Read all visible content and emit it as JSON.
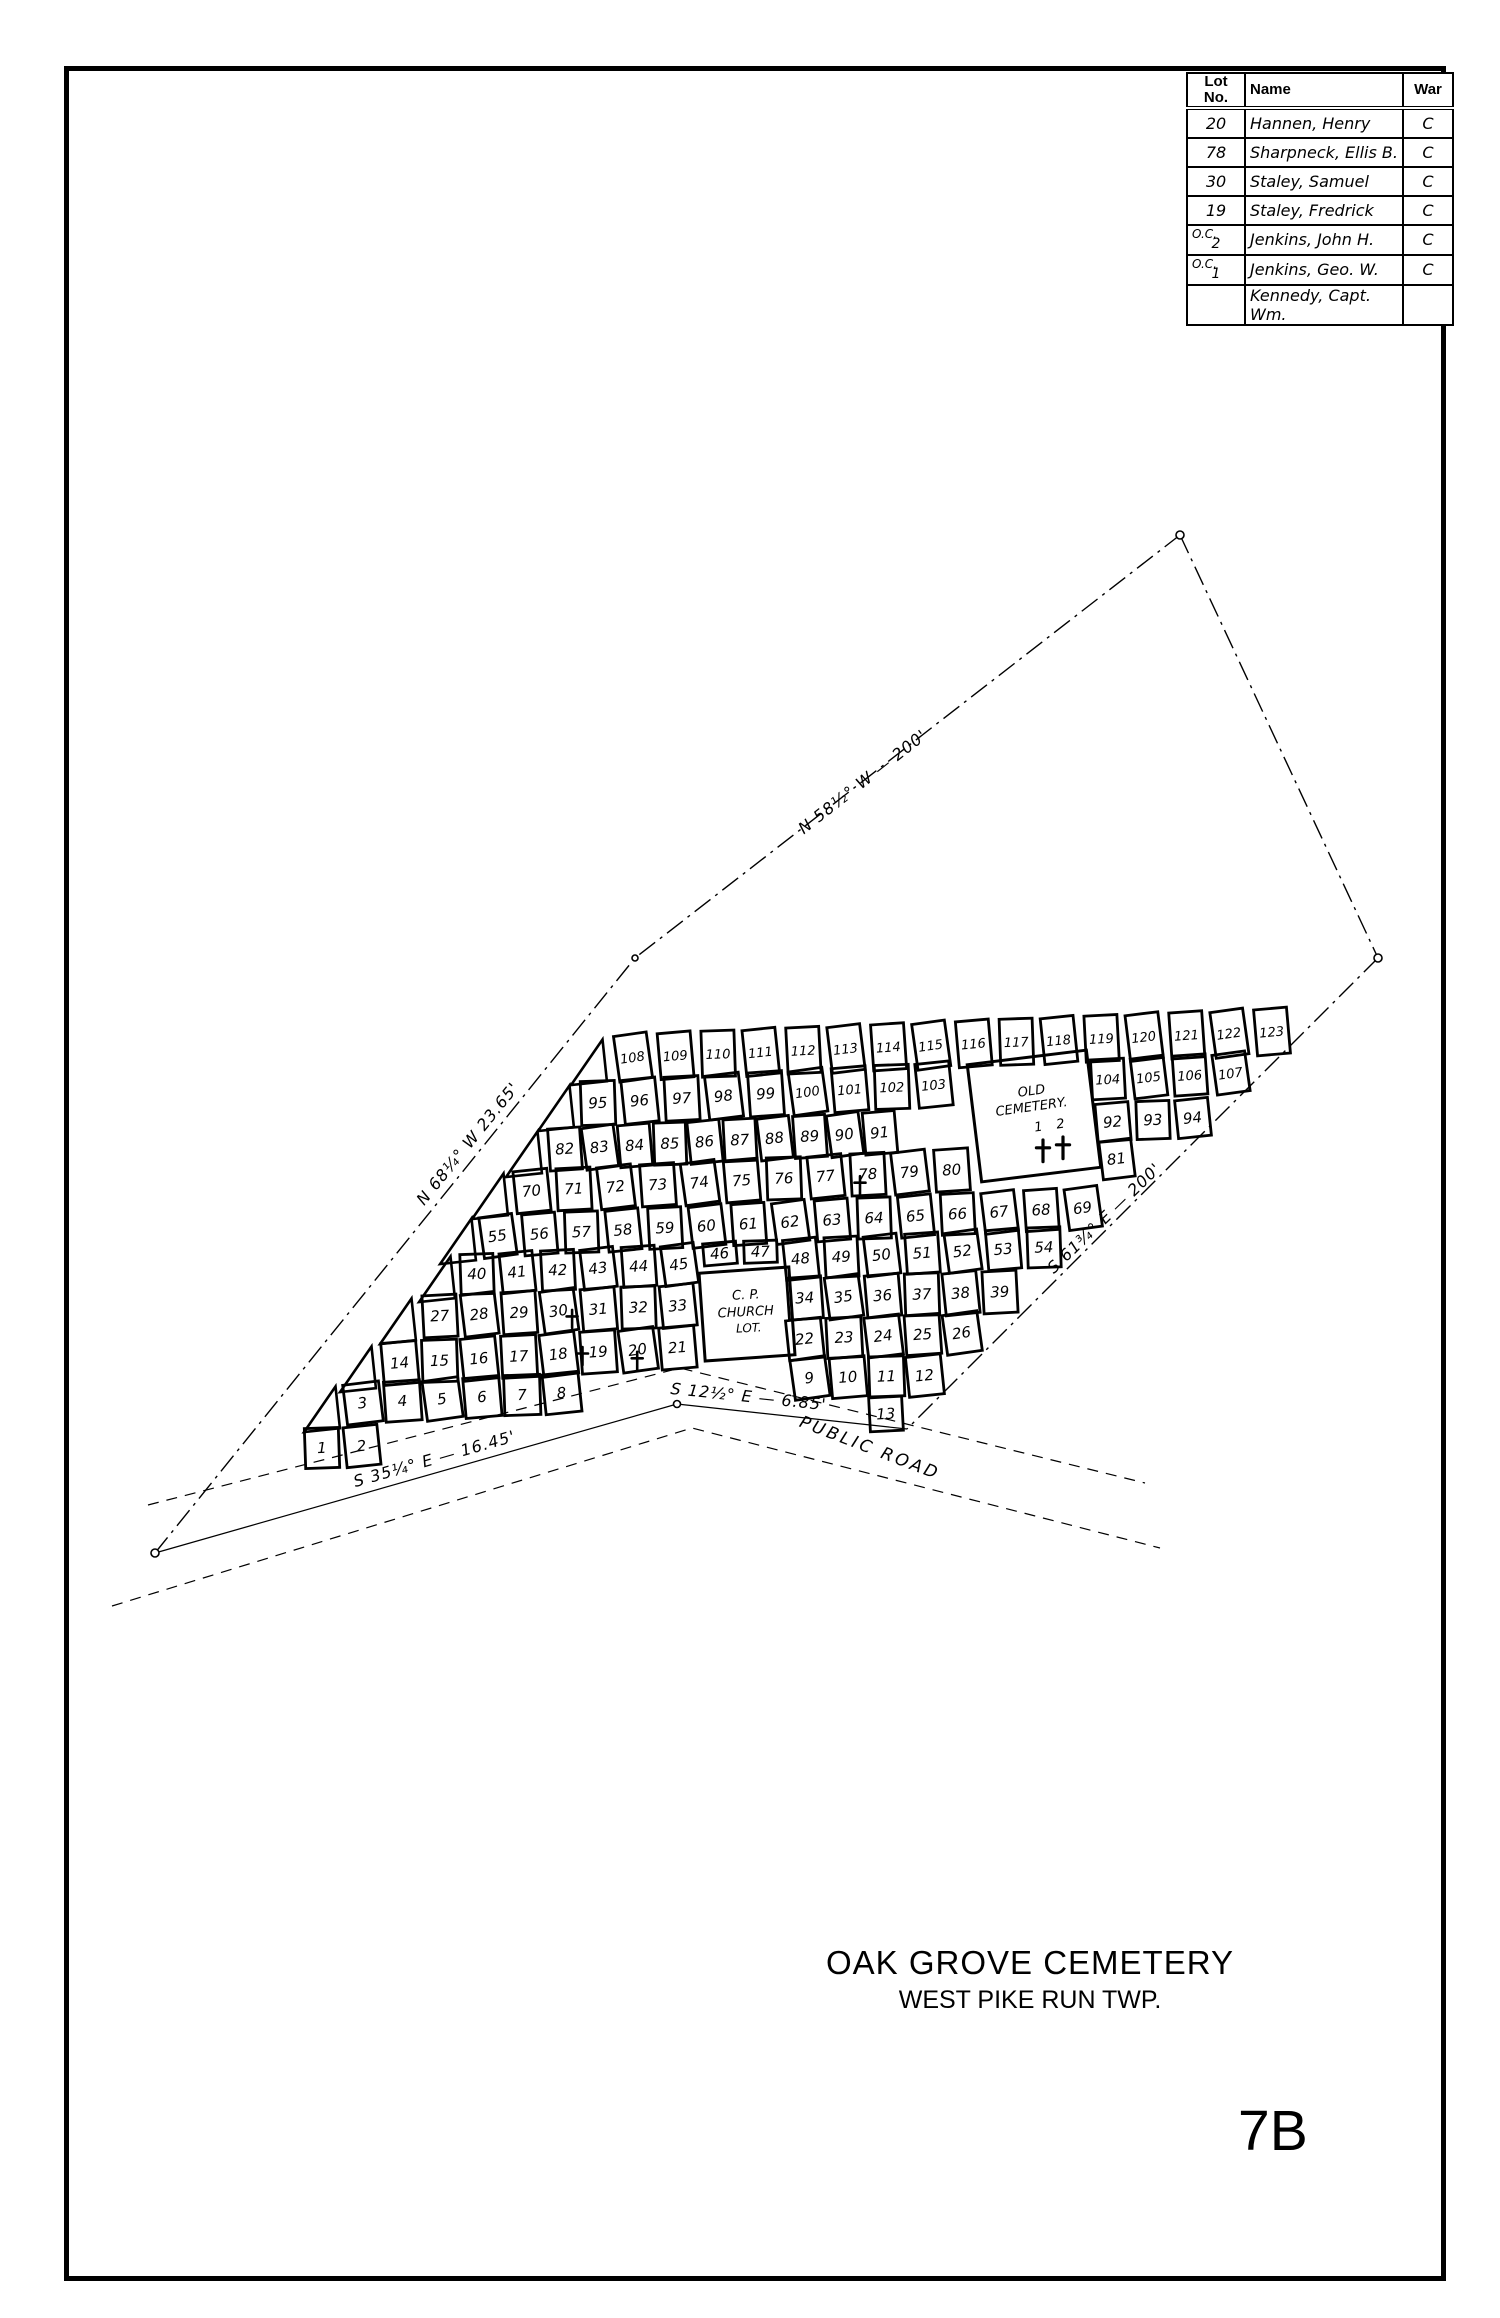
{
  "page": {
    "number": "7B"
  },
  "title": {
    "main": "OAK GROVE CEMETERY",
    "sub": "WEST PIKE RUN TWP."
  },
  "table": {
    "headers": {
      "lot": "Lot\nNo.",
      "name": "Name",
      "war": "War"
    },
    "rows": [
      {
        "lot_lines": [
          "20"
        ],
        "name": "Hannen, Henry",
        "war": "C"
      },
      {
        "lot_lines": [
          "78"
        ],
        "name": "Sharpneck, Ellis B.",
        "war": "C"
      },
      {
        "lot_lines": [
          "30"
        ],
        "name": "Staley, Samuel",
        "war": "C"
      },
      {
        "lot_lines": [
          "19"
        ],
        "name": "Staley, Fredrick",
        "war": "C"
      },
      {
        "lot_lines": [
          "O.C.",
          "2"
        ],
        "name": "Jenkins, John H.",
        "war": "C"
      },
      {
        "lot_lines": [
          "O.C.",
          "1"
        ],
        "name": "Jenkins, Geo. W.",
        "war": "C"
      },
      {
        "lot_lines": [
          ""
        ],
        "name": "Kennedy, Capt. Wm.",
        "war": ""
      }
    ]
  },
  "plat": {
    "bearings": {
      "left": "N 68¼° W   23.65'",
      "top": "N 58½° W — 200'",
      "right": "S 61¾° E — 200'",
      "road_mid": "S 12½° E — 6.85'",
      "road_left": "S 35¼° E — 16.45'"
    },
    "labels": {
      "road": "PUBLIC ROAD",
      "old_cemetery": [
        "OLD",
        "CEMETERY."
      ],
      "church": [
        "C. P.",
        "CHURCH",
        "LOT."
      ],
      "old_cemetery_graves": [
        "1",
        "2"
      ]
    },
    "rows": [
      {
        "lots": [
          "108",
          "109",
          "110",
          "111",
          "112",
          "113",
          "114",
          "115",
          "116",
          "117",
          "118",
          "119",
          "120",
          "121",
          "122",
          "123"
        ]
      },
      {
        "lots": [
          "95",
          "96",
          "97",
          "98",
          "99",
          "100",
          "101",
          "102",
          "103"
        ]
      },
      {
        "lots": [
          "104",
          "105",
          "106",
          "107"
        ]
      },
      {
        "lots": [
          "82",
          "83",
          "84",
          "85",
          "86",
          "87",
          "88",
          "89",
          "90",
          "91"
        ]
      },
      {
        "lots": [
          "92",
          "93",
          "94"
        ]
      },
      {
        "lots": [
          "70",
          "71",
          "72",
          "73",
          "74",
          "75",
          "76",
          "77",
          "78",
          "79",
          "80"
        ]
      },
      {
        "lots": [
          "81"
        ]
      },
      {
        "lots": [
          "55",
          "56",
          "57",
          "58",
          "59",
          "60",
          "61",
          "62",
          "63",
          "64",
          "65",
          "66",
          "67",
          "68",
          "69"
        ]
      },
      {
        "lots": [
          "40",
          "41",
          "42",
          "43",
          "44",
          "45",
          "46",
          "47",
          "48",
          "49",
          "50",
          "51",
          "52",
          "53",
          "54"
        ]
      },
      {
        "lots": [
          "27",
          "28",
          "29",
          "30",
          "31",
          "32",
          "33"
        ]
      },
      {
        "lots": [
          "34",
          "35",
          "36",
          "37",
          "38",
          "39"
        ]
      },
      {
        "lots": [
          "14",
          "15",
          "16",
          "17",
          "18",
          "19",
          "20",
          "21"
        ]
      },
      {
        "lots": [
          "22",
          "23",
          "24",
          "25",
          "26"
        ]
      },
      {
        "lots": [
          "3",
          "4",
          "5",
          "6",
          "7",
          "8"
        ]
      },
      {
        "lots": [
          "9",
          "10",
          "11",
          "12"
        ]
      },
      {
        "lots": [
          "1",
          "2"
        ]
      },
      {
        "lots": [
          "13"
        ]
      }
    ],
    "veteran_cross_lots": [
      "19",
      "20",
      "30",
      "78"
    ]
  }
}
